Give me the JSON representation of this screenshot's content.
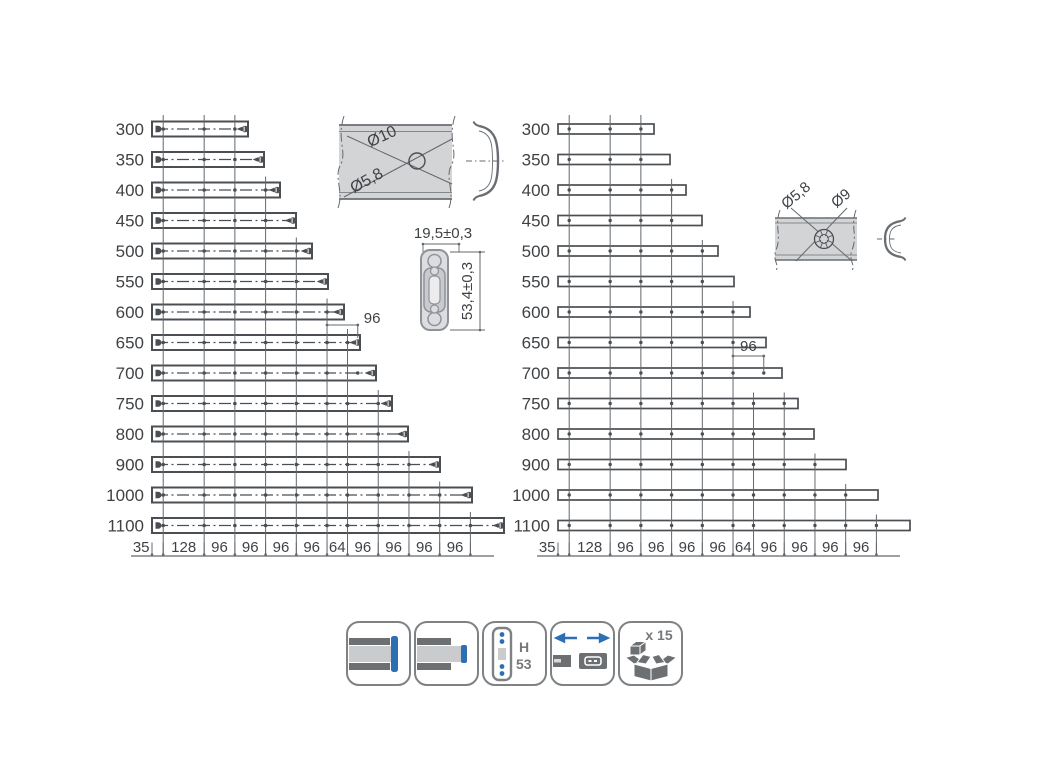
{
  "colors": {
    "text": "#3f4245",
    "line": "#64686c",
    "bar_stroke": "#4b4f53",
    "band_fill": "#d3d4d6",
    "band_edge": "#6a6e72",
    "detail_stroke": "#8f9398",
    "detail_fill": "#dcdde0",
    "detail_fill2": "#c8cacd",
    "blue": "#2e6fb4",
    "icon_gray": "#6d7073"
  },
  "drawing": {
    "scale_px_per_mm": 0.32,
    "axis_y": 556,
    "grid_top_y": 115,
    "row_y_start": 129,
    "row_y_step": 30.5,
    "grid_mm": [
      35,
      163,
      259,
      355,
      451,
      547,
      611,
      707,
      803,
      899,
      995
    ],
    "axis_segment_labels": [
      "35",
      "128",
      "96",
      "96",
      "96",
      "96",
      "64",
      "96",
      "96",
      "96",
      "96"
    ],
    "panels": [
      {
        "name": "cabinet-member-panel",
        "rail_x": 152,
        "bar_h": 15,
        "style": "detailed",
        "dim96": {
          "label": "96",
          "from_mm": 547,
          "to_mm": 643,
          "above_row": 7,
          "label_pos": "right"
        },
        "rows": [
          {
            "label": "300",
            "length": 300,
            "holes_mm": [
              35,
              163,
              259
            ],
            "end_hole_mm": 291
          },
          {
            "label": "350",
            "length": 350,
            "holes_mm": [
              35,
              163,
              259
            ],
            "end_hole_mm": 341
          },
          {
            "label": "400",
            "length": 400,
            "holes_mm": [
              35,
              163,
              259,
              355
            ],
            "end_hole_mm": 391
          },
          {
            "label": "450",
            "length": 450,
            "holes_mm": [
              35,
              163,
              259,
              355
            ],
            "end_hole_mm": 441
          },
          {
            "label": "500",
            "length": 500,
            "holes_mm": [
              35,
              163,
              259,
              355,
              451
            ],
            "end_hole_mm": 491
          },
          {
            "label": "550",
            "length": 550,
            "holes_mm": [
              35,
              163,
              259,
              355,
              451
            ],
            "end_hole_mm": 541
          },
          {
            "label": "600",
            "length": 600,
            "holes_mm": [
              35,
              163,
              259,
              355,
              451,
              547
            ],
            "end_hole_mm": 591
          },
          {
            "label": "650",
            "length": 650,
            "holes_mm": [
              35,
              163,
              259,
              355,
              451,
              547,
              611
            ],
            "end_hole_mm": 643
          },
          {
            "label": "700",
            "length": 700,
            "holes_mm": [
              35,
              163,
              259,
              355,
              451,
              547,
              643
            ],
            "end_hole_mm": 691
          },
          {
            "label": "750",
            "length": 750,
            "holes_mm": [
              35,
              163,
              259,
              355,
              451,
              547,
              611,
              707
            ],
            "end_hole_mm": 741
          },
          {
            "label": "800",
            "length": 800,
            "holes_mm": [
              35,
              163,
              259,
              355,
              451,
              547,
              611,
              707
            ],
            "end_hole_mm": 791
          },
          {
            "label": "900",
            "length": 900,
            "holes_mm": [
              35,
              163,
              259,
              355,
              451,
              547,
              611,
              707,
              803
            ],
            "end_hole_mm": 891
          },
          {
            "label": "1000",
            "length": 1000,
            "holes_mm": [
              35,
              163,
              259,
              355,
              451,
              547,
              611,
              707,
              803,
              899
            ],
            "end_hole_mm": 991
          },
          {
            "label": "1100",
            "length": 1100,
            "holes_mm": [
              35,
              163,
              259,
              355,
              451,
              547,
              611,
              707,
              803,
              899,
              995
            ],
            "end_hole_mm": 1091
          }
        ]
      },
      {
        "name": "drawer-member-panel",
        "rail_x": 558,
        "bar_h": 10,
        "style": "simple",
        "dim96": {
          "label": "96",
          "from_mm": 547,
          "to_mm": 643,
          "above_row": 8,
          "label_pos": "above"
        },
        "rows": [
          {
            "label": "300",
            "length": 300,
            "holes_mm": [
              35,
              163,
              259
            ]
          },
          {
            "label": "350",
            "length": 350,
            "holes_mm": [
              35,
              163,
              259
            ]
          },
          {
            "label": "400",
            "length": 400,
            "holes_mm": [
              35,
              163,
              259,
              355
            ]
          },
          {
            "label": "450",
            "length": 450,
            "holes_mm": [
              35,
              163,
              259,
              355
            ]
          },
          {
            "label": "500",
            "length": 500,
            "holes_mm": [
              35,
              163,
              259,
              355,
              451
            ]
          },
          {
            "label": "550",
            "length": 550,
            "holes_mm": [
              35,
              163,
              259,
              355,
              451
            ]
          },
          {
            "label": "600",
            "length": 600,
            "holes_mm": [
              35,
              163,
              259,
              355,
              451,
              547
            ]
          },
          {
            "label": "650",
            "length": 650,
            "holes_mm": [
              35,
              163,
              259,
              355,
              451,
              547
            ]
          },
          {
            "label": "700",
            "length": 700,
            "holes_mm": [
              35,
              163,
              259,
              355,
              451,
              547,
              643
            ]
          },
          {
            "label": "750",
            "length": 750,
            "holes_mm": [
              35,
              163,
              259,
              355,
              451,
              547,
              611,
              707
            ]
          },
          {
            "label": "800",
            "length": 800,
            "holes_mm": [
              35,
              163,
              259,
              355,
              451,
              547,
              611,
              707
            ]
          },
          {
            "label": "900",
            "length": 900,
            "holes_mm": [
              35,
              163,
              259,
              355,
              451,
              547,
              611,
              707,
              803
            ]
          },
          {
            "label": "1000",
            "length": 1000,
            "holes_mm": [
              35,
              163,
              259,
              355,
              451,
              547,
              611,
              707,
              803,
              899
            ]
          },
          {
            "label": "1100",
            "length": 1100,
            "holes_mm": [
              35,
              163,
              259,
              355,
              451,
              547,
              611,
              707,
              803,
              899,
              995
            ]
          }
        ]
      }
    ]
  },
  "details": {
    "hole_detail_top": {
      "dia_outer": "Ø10",
      "dia_inner": "Ø5,8"
    },
    "profile_detail": {
      "width_dim": "19,5±0,3",
      "height_dim": "53,4±0,3"
    },
    "hole_detail_right": {
      "dia_inner": "Ø5,8",
      "dia_outer": "Ø9"
    }
  },
  "icons": {
    "height_label_top": "H",
    "height_label_bottom": "53",
    "quantity_label": "x 15"
  }
}
